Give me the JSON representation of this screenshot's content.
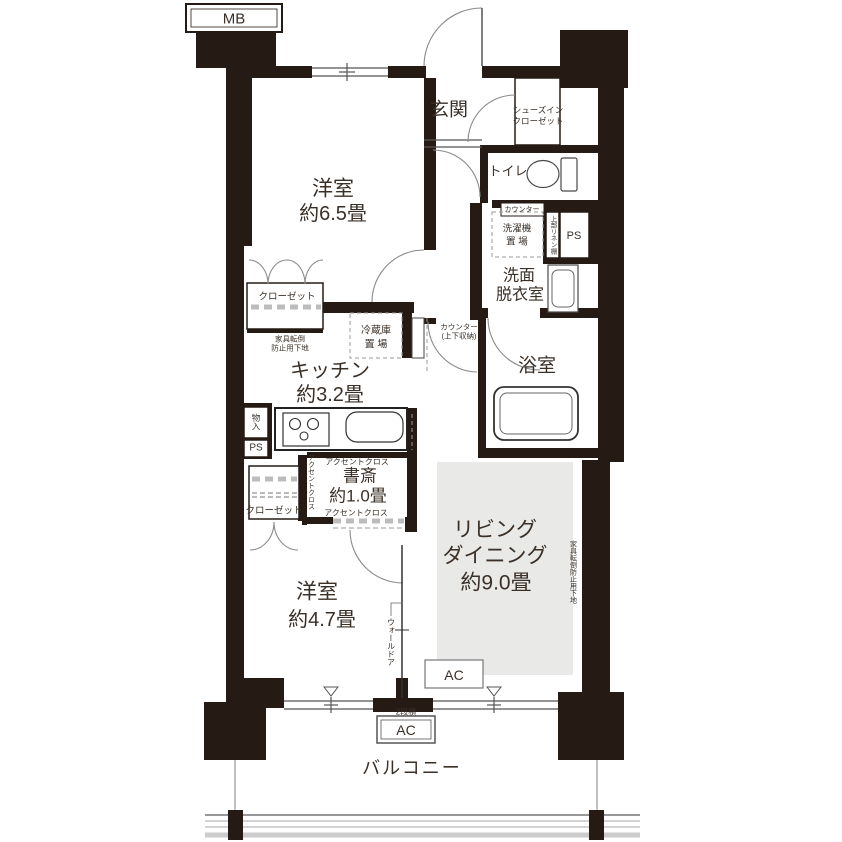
{
  "floorplan": {
    "mb": "MB",
    "genkan": {
      "label": "玄関"
    },
    "shoes_closet": {
      "line1": "シューズイン",
      "line2": "クローゼット"
    },
    "toilet": {
      "label": "トイレ"
    },
    "counter_tab": "カウンター",
    "washer": {
      "line1": "洗濯機",
      "line2": "置 場"
    },
    "linen_shelf": "上部リネン棚",
    "ps_right": "PS",
    "washroom": {
      "line1": "洗面",
      "line2": "脱衣室"
    },
    "bathroom": {
      "label": "浴室"
    },
    "bedroom1": {
      "name": "洋室",
      "size": "約6.5畳"
    },
    "closet_upper": "クローゼット",
    "anti_tip_left": {
      "line1": "家具転倒",
      "line2": "防止用下地"
    },
    "fridge": {
      "line1": "冷蔵庫",
      "line2": "置 場"
    },
    "kitchen": {
      "name": "キッチン",
      "size": "約3.2畳"
    },
    "counter_storage": {
      "line1": "カウンター",
      "line2": "(上下収納)"
    },
    "mono_ire": "物入",
    "ps_left": "PS",
    "accent_top": "アクセントクロス",
    "accent_left": "アクセントクロス",
    "accent_bottom": "アクセントクロス",
    "study": {
      "name": "書斎",
      "size": "約1.0畳"
    },
    "closet_lower": "クローゼット",
    "bedroom2": {
      "name": "洋室",
      "size": "約4.7畳"
    },
    "wall_door": "ウォールドア",
    "living": {
      "line1": "リビング",
      "line2": "ダイニング",
      "line3": "約9.0畳"
    },
    "anti_tip_right": "家具転倒防止用下地",
    "ac_living": "AC",
    "ac_stack_note": "2段積",
    "ac_lower": "AC",
    "balcony": "バルコニー",
    "colors": {
      "wall": "#261b14",
      "living_zone": "#e9e9e7",
      "dash_gray": "#bcbcbc"
    }
  }
}
